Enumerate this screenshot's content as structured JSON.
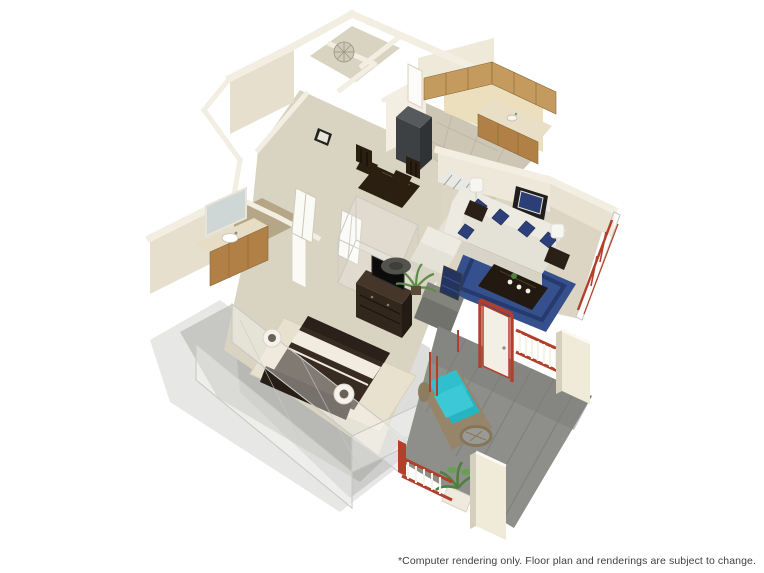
{
  "page": {
    "background": "#ffffff"
  },
  "disclaimer": "*Computer rendering only. Floor plan and renderings are subject to change.",
  "colors": {
    "page_bg": "#ffffff",
    "text_gray": "#3f3f3d",
    "wall_light": "#f3eee2",
    "wall_mid": "#e6dfcd",
    "wall_shadow": "#d2cab6",
    "wall_tan": "#ecdfbd",
    "floor_carpet": "#d9d3c2",
    "floor_tile": "#cdc6b4",
    "bath_tile": "#b5a687",
    "cabinet_wood": "#c49a5f",
    "cabinet_wood_dark": "#b08046",
    "counter_cream": "#e9dfc7",
    "appliance_dark": "#3d4144",
    "dark_wood": "#32271c",
    "tv_black": "#0c0c0c",
    "bed_dark": "#382c22",
    "bed_stripe": "#f1ecdf",
    "rug_cream": "#e8e1cd",
    "sofa_white": "#eceae1",
    "pillow_navy": "#2e4079",
    "rug_navy": "#36508d",
    "rug_navy_dark": "#253a6d",
    "lamp_white": "#f7f6f1",
    "mirror_frame": "#1e1e1e",
    "accent_red": "#b13f2c",
    "deck_gray": "#8e8e8a",
    "teal": "#2fbfcd",
    "teal_dark": "#26b3c2",
    "wicker_tan": "#97856a",
    "plant_green": "#4e8040",
    "shadow_gray": "#a7a7a3",
    "ghost_line": "#c9c9c4"
  },
  "scene": {
    "type": "3d-isometric-floor-plan-rendering",
    "rooms": [
      {
        "name": "laundry-utility",
        "features": [
          "decorative-fan"
        ]
      },
      {
        "name": "kitchen",
        "features": [
          "l-shaped-oak-cabinets",
          "refrigerator",
          "counter-with-sink",
          "tile-floor",
          "striped-floor-mat"
        ]
      },
      {
        "name": "dining-area",
        "features": [
          "dark-wood-table",
          "two-dark-chairs"
        ]
      },
      {
        "name": "hallway",
        "features": [
          "bifold-closet-doors",
          "ghost-closet-wireframe",
          "wall-art"
        ]
      },
      {
        "name": "bathroom",
        "features": [
          "wood-vanity",
          "white-sink",
          "wall-mirror",
          "tan-tile-floor"
        ]
      },
      {
        "name": "living-room",
        "features": [
          "white-sofa-navy-pillows",
          "white-armchair",
          "navy-area-rug",
          "dark-coffee-table",
          "two-table-lamps",
          "navy-wall-mirror",
          "gray-tv-console",
          "ghost-walls-red-window-frames"
        ]
      },
      {
        "name": "bedroom",
        "features": [
          "bed-dark-bedding-white-stripe",
          "dark-headboard",
          "cream-rug",
          "dresser-with-flat-tv",
          "palm-plant",
          "round-ottoman",
          "navy-shelf",
          "two-wall-sconces",
          "ghost-cutaway-walls"
        ]
      },
      {
        "name": "balcony-patio",
        "features": [
          "gray-plank-deck",
          "red-entry-door",
          "teal-wicker-sofa",
          "round-wicker-table",
          "potted-plant",
          "red-white-railings",
          "cream-pillars"
        ]
      }
    ]
  }
}
